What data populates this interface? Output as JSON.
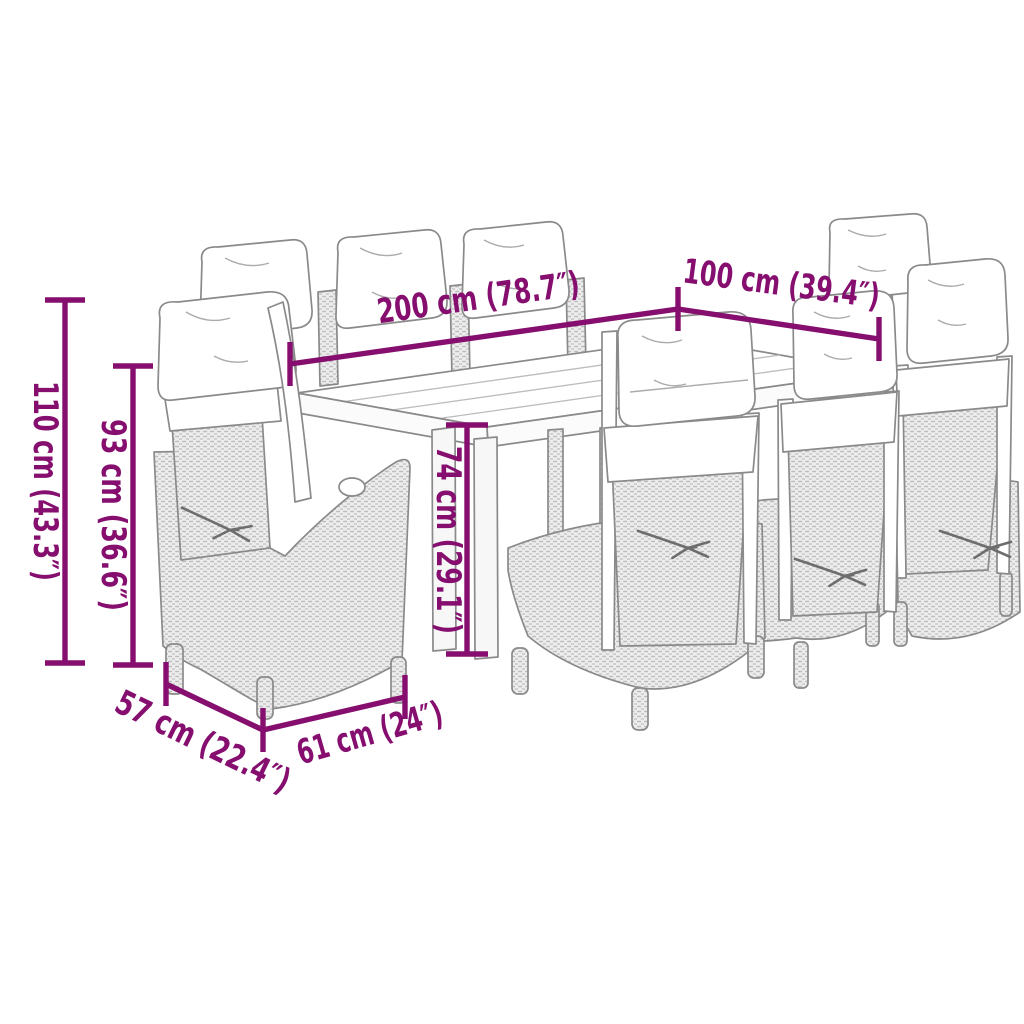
{
  "diagram": {
    "scene": "Line drawing of an outdoor dining set: long rectangular table with eight reclining rattan chairs with back cushions and tie cords",
    "accent_color": "#850E6F",
    "artwork_color": "#8A8A8A",
    "background_color": "#FFFFFF",
    "dimensions": [
      {
        "name": "overall-height",
        "value": "110 cm (43.3″)"
      },
      {
        "name": "chair-back-height",
        "value": "93 cm (36.6″)"
      },
      {
        "name": "table-length",
        "value": "200 cm (78.7″)"
      },
      {
        "name": "table-width",
        "value": "100 cm (39.4″)"
      },
      {
        "name": "table-height",
        "value": "74 cm (29.1″)"
      },
      {
        "name": "chair-depth",
        "value": "57 cm (22.4″)"
      },
      {
        "name": "chair-width",
        "value": "61 cm (24″)"
      }
    ]
  }
}
